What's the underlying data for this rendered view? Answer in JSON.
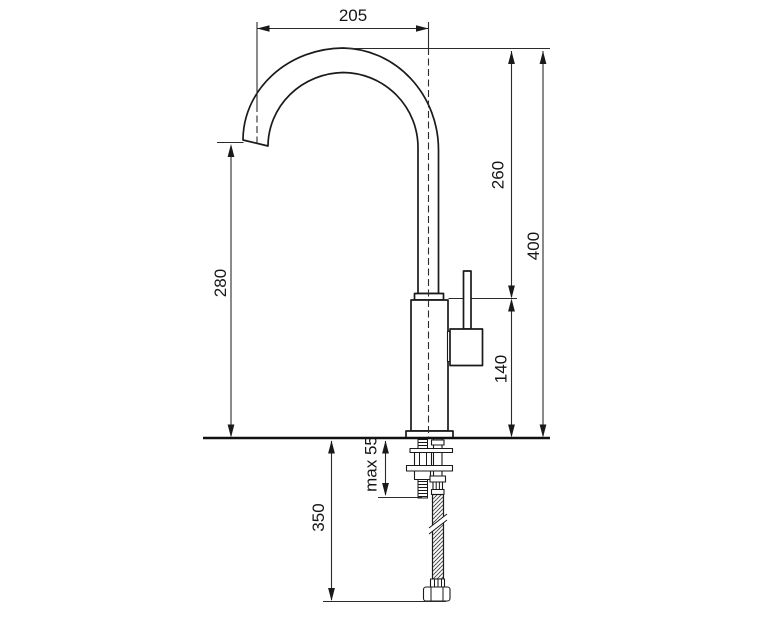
{
  "drawing": {
    "subject": "kitchen-faucet-installation-dimension-diagram",
    "background": "#ffffff",
    "line_color": "#1a1a1a",
    "labels": {
      "spout_reach": "205",
      "upper_section_height": "260",
      "overall_height": "400",
      "spout_outlet_height": "280",
      "body_section_height": "140",
      "max_counter_thickness": "max 55",
      "hose_length": "350"
    }
  }
}
